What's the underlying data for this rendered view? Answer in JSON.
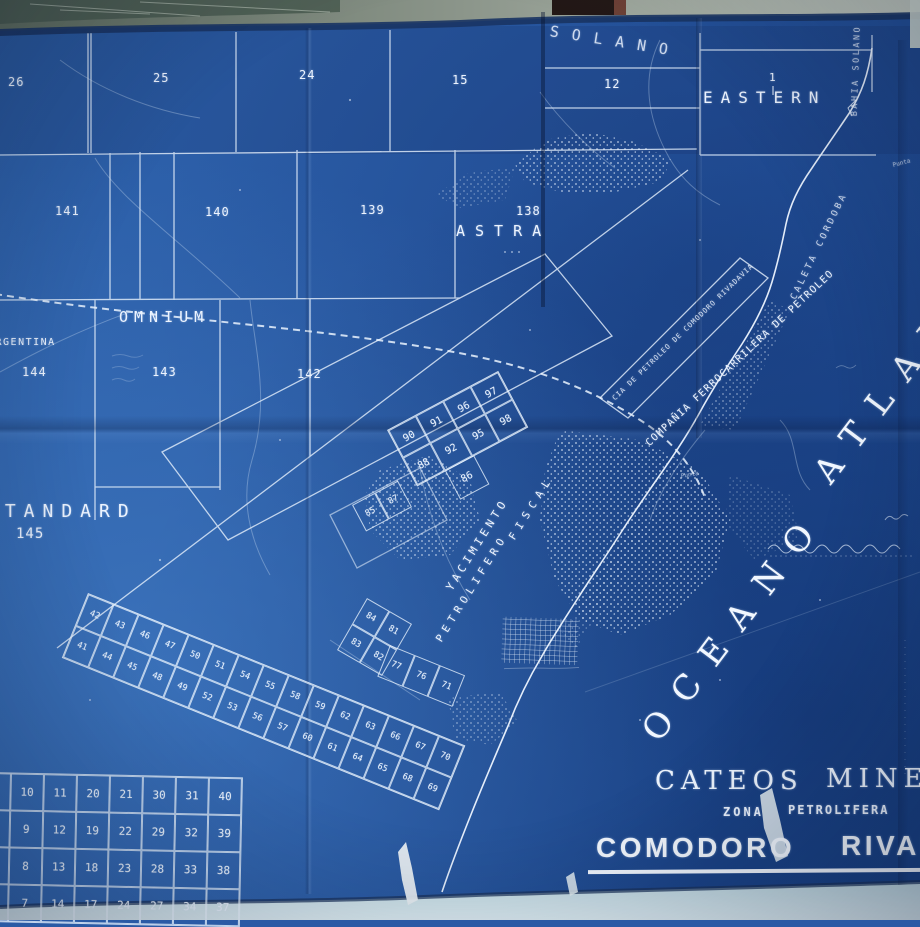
{
  "title_block": {
    "cateos": "CATEOS",
    "mineros": "MINEROS",
    "zona": "ZONA",
    "petrolifera": "PETROLIFERA",
    "comodoro": "COMODORO",
    "rivadavia": "RIVADAVIA"
  },
  "regions": {
    "solano": "SOLANO",
    "eastern": "EASTERN",
    "astra": "ASTRA",
    "omnium": "OMNIUM",
    "argentina": "ARGENTINA",
    "standard": "STANDARD"
  },
  "ocean": {
    "word1": "OCEANO",
    "word2": "ATLANTICO"
  },
  "coast_labels": {
    "bahia_solano": "BAHIA SOLANO",
    "caleta_cordoba": "CALETA CORDOBA",
    "punta_a": "Punta",
    "punta_b": "Punta"
  },
  "company_labels": {
    "yacimiento": "YACIMIENTO",
    "petrolifero": "PETROLIFERO",
    "fiscal": "FISCAL",
    "ferrocarrilera": "COMPAÑIA FERROCARRILERA DE PETROLEO",
    "cia_strip": "CIA DE PETROLEO DE COMODORO RIVADAVIA"
  },
  "parcel_numbers": {
    "top_row": [
      "26",
      "25",
      "24",
      "15",
      "12"
    ],
    "eastern_num": "1",
    "second_row": [
      "141",
      "140",
      "139",
      "138"
    ],
    "third_row": [
      "144",
      "143",
      "142"
    ],
    "standard_num": "145"
  },
  "central_grid": {
    "rows": [
      [
        "90",
        "91",
        "96",
        "97"
      ],
      [
        "88",
        "92",
        "95",
        "98"
      ]
    ],
    "below": "86",
    "pair": [
      "85",
      "87"
    ]
  },
  "strip_grid": {
    "top_row": [
      "42",
      "43",
      "46",
      "47",
      "50",
      "51",
      "54",
      "55",
      "58",
      "59",
      "62",
      "63",
      "66",
      "67",
      "70"
    ],
    "bottom_row": [
      "41",
      "44",
      "45",
      "48",
      "49",
      "52",
      "53",
      "56",
      "57",
      "60",
      "61",
      "64",
      "65",
      "68",
      "69"
    ],
    "upper_ext": [
      "77",
      "76",
      "71"
    ],
    "corner_block": [
      [
        "84",
        "81"
      ],
      [
        "83",
        "82"
      ]
    ]
  },
  "index_table": {
    "rows": [
      [
        "10",
        "11",
        "20",
        "21",
        "30",
        "31",
        "40"
      ],
      [
        "9",
        "12",
        "19",
        "22",
        "29",
        "32",
        "39"
      ],
      [
        "8",
        "13",
        "18",
        "23",
        "28",
        "33",
        "38"
      ],
      [
        "7",
        "14",
        "17",
        "24",
        "27",
        "34",
        "37"
      ]
    ]
  },
  "colors": {
    "map_blue": "#2a5aa5",
    "line_white": "#e8f2fd",
    "wall_gray": "#8b958a",
    "table_strip": "#cfe2ea",
    "map_edge_navy": "#1b3765"
  }
}
